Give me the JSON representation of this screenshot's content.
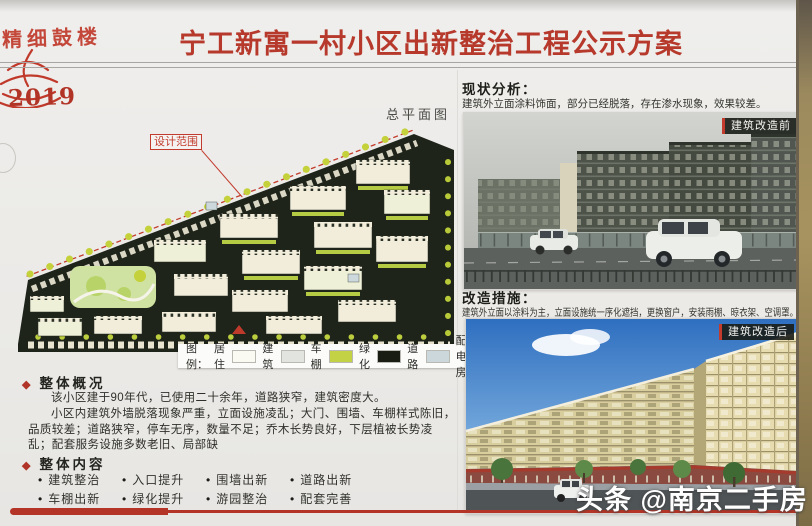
{
  "badge": {
    "slogan": "精细鼓楼",
    "year": "2019"
  },
  "header": {
    "title": "宁工新寓一村小区出新整治工程公示方案"
  },
  "site_plan": {
    "caption": "总平面图",
    "design_scope": "设计范围",
    "legend_title": "图例：",
    "legend": [
      {
        "label": "居住",
        "swatch": "#fbfaf2"
      },
      {
        "label": "建筑",
        "swatch": "#e2e5df"
      },
      {
        "label": "车棚",
        "swatch": "#c3d244"
      },
      {
        "label": "绿化",
        "swatch": "#181c12"
      },
      {
        "label": "道路",
        "swatch": "#cbd7db"
      },
      {
        "label": "配电房",
        "swatch": null
      }
    ]
  },
  "analysis": {
    "heading": "现状分析：",
    "body": "建筑外立面涂料饰面，部分已经脱落，存在渗水现象，效果较差。",
    "photo_tag": "建筑改造前"
  },
  "measures": {
    "heading": "改造措施：",
    "body": "建筑外立面以涂料为主，立面设施统一序化遮挡，更换窗户，安装雨棚、晾衣架、空调罩。",
    "photo_tag": "建筑改造后"
  },
  "overview": {
    "bullet": "◆",
    "heading": "整体概况",
    "para1": "该小区建于90年代，已使用二十余年，道路狭窄，建筑密度大。",
    "para2": "小区内建筑外墙脱落现象严重，立面设施凌乱；大门、围墙、车棚样式陈旧，品质较差；道路狭窄，停车无序，数量不足；乔木长势良好，下层植被长势凌乱；配套服务设施多数老旧、局部缺"
  },
  "contents": {
    "bullet": "◆",
    "heading": "整体内容",
    "items": [
      "建筑整治",
      "入口提升",
      "围墙出新",
      "道路出新",
      "车棚出新",
      "绿化提升",
      "游园整治",
      "配套完善"
    ]
  },
  "watermark": "头条 @南京二手房",
  "colors": {
    "title_red": "#b6392c",
    "accent_red": "#c23b2c",
    "map_green": "#c3d244",
    "map_road": "#1e241a",
    "ribbon_red": "#b43527"
  }
}
